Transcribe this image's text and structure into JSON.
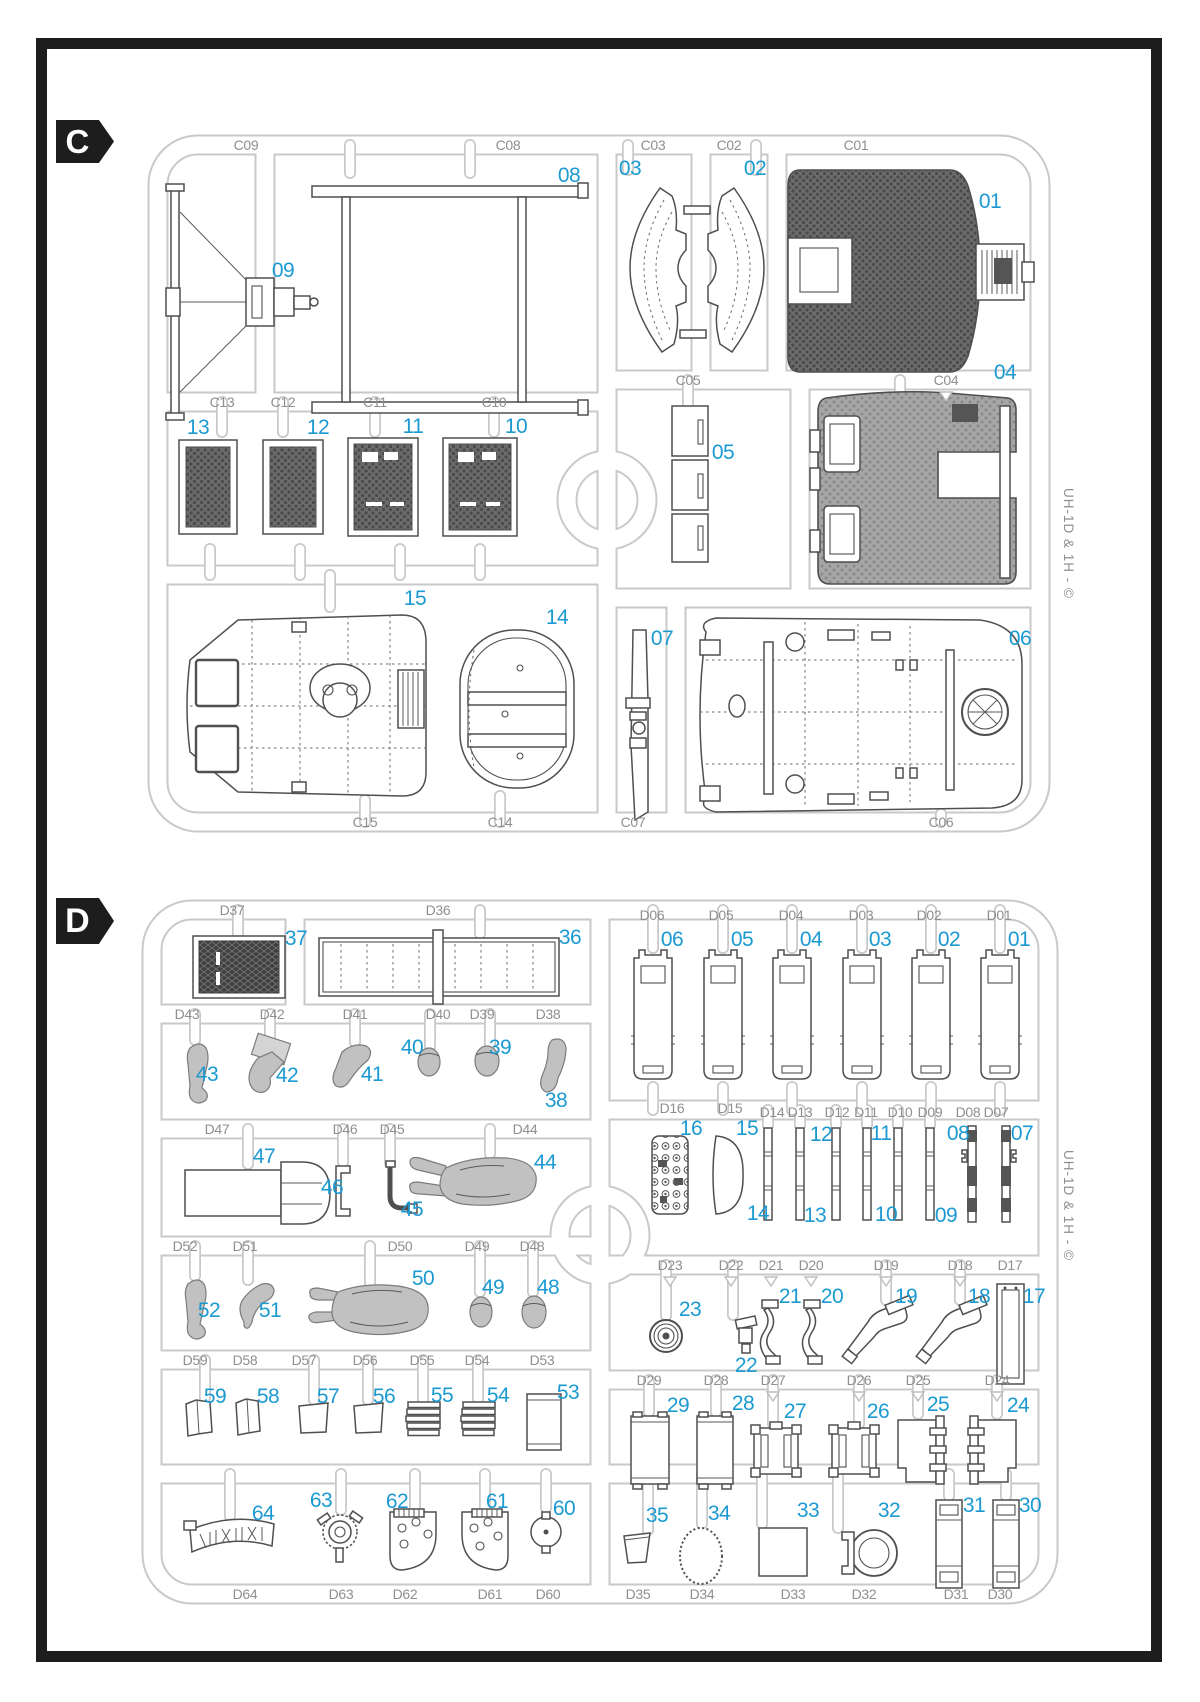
{
  "page": {
    "kit_code": "UH-1D & 1H - ©"
  },
  "colors": {
    "part_number_blue": "#1b9ad2",
    "label_gray": "#8f8f8f",
    "runner_gray": "#c9c9c9",
    "frame_black": "#1d1d1d"
  },
  "sprue_c": {
    "badge": "C",
    "gate_labels": [
      "C09",
      "C08",
      "C03",
      "C02",
      "C01",
      "C13",
      "C12",
      "C11",
      "C10",
      "C05",
      "C04",
      "C15",
      "C14",
      "C07",
      "C06"
    ],
    "part_numbers": [
      "08",
      "03",
      "02",
      "01",
      "09",
      "13",
      "12",
      "11",
      "10",
      "05",
      "04",
      "15",
      "14",
      "07",
      "06"
    ]
  },
  "sprue_d": {
    "badge": "D",
    "gate_labels": [
      "D37",
      "D36",
      "D06",
      "D05",
      "D04",
      "D03",
      "D02",
      "D01",
      "D43",
      "D42",
      "D41",
      "D40",
      "D39",
      "D38",
      "D47",
      "D46",
      "D45",
      "D44",
      "D16",
      "D15",
      "D14",
      "D13",
      "D12",
      "D11",
      "D10",
      "D09",
      "D08",
      "D07",
      "D52",
      "D51",
      "D50",
      "D49",
      "D48",
      "D23",
      "D22",
      "D21",
      "D20",
      "D19",
      "D18",
      "D17",
      "D59",
      "D58",
      "D57",
      "D56",
      "D55",
      "D54",
      "D53",
      "D29",
      "D28",
      "D27",
      "D26",
      "D25",
      "D24",
      "D64",
      "D63",
      "D62",
      "D61",
      "D60",
      "D35",
      "D34",
      "D33",
      "D32",
      "D31",
      "D30"
    ],
    "part_numbers": [
      "37",
      "36",
      "06",
      "05",
      "04",
      "03",
      "02",
      "01",
      "43",
      "42",
      "41",
      "40",
      "39",
      "38",
      "47",
      "46",
      "45",
      "44",
      "16",
      "15",
      "12",
      "11",
      "08",
      "07",
      "14",
      "13",
      "10",
      "09",
      "52",
      "51",
      "50",
      "49",
      "48",
      "23",
      "22",
      "21",
      "20",
      "19",
      "18",
      "17",
      "59",
      "58",
      "57",
      "56",
      "55",
      "54",
      "53",
      "29",
      "28",
      "27",
      "26",
      "25",
      "24",
      "64",
      "63",
      "62",
      "61",
      "60",
      "35",
      "34",
      "33",
      "32",
      "31",
      "30"
    ]
  }
}
